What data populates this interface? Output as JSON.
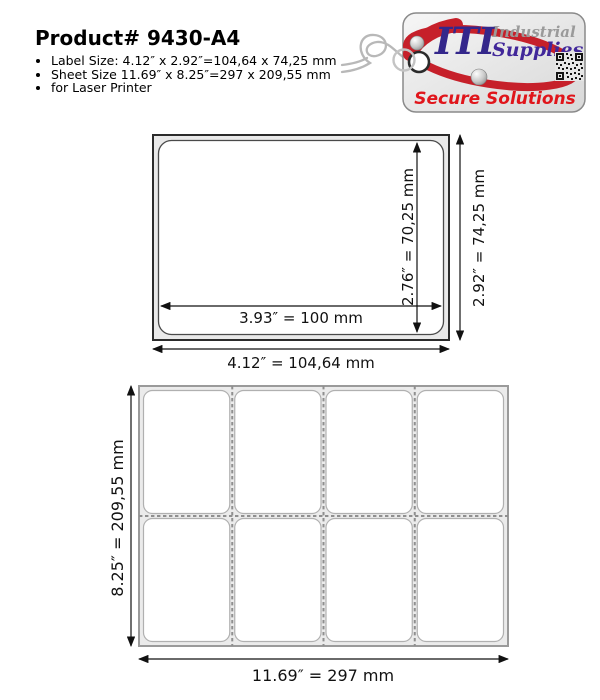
{
  "header": {
    "title": "Product# 9430-A4",
    "bullets": [
      "Label Size: 4.12″ x 2.92″=104,64 x 74,25 mm",
      "Sheet Size 11.69″ x 8.25″=297 x 209,55 mm",
      "for Laser Printer"
    ]
  },
  "logo": {
    "iti": "ITI",
    "industrial": "Industrial",
    "supplies": "Supplies",
    "tagline": "Secure Solutions",
    "colors": {
      "swoosh_red": "#c6202a",
      "iti_purple": "#34278b",
      "supplies_purple": "#41279a",
      "industrial_gray": "#9a9a9a",
      "tagline_red": "#e0151b",
      "tag_border": "#8a8a8a"
    }
  },
  "label_diagram": {
    "dim_inner_width": "3.93″ = 100 mm",
    "dim_inner_height": "2.76″ = 70,25 mm",
    "dim_outer_height": "2.92″ = 74,25 mm",
    "dim_outer_width": "4.12″ = 104,64 mm"
  },
  "sheet_diagram": {
    "rows": 2,
    "columns": 4,
    "dim_height": "8.25″ = 209,55 mm",
    "dim_width": "11.69″ = 297 mm"
  }
}
